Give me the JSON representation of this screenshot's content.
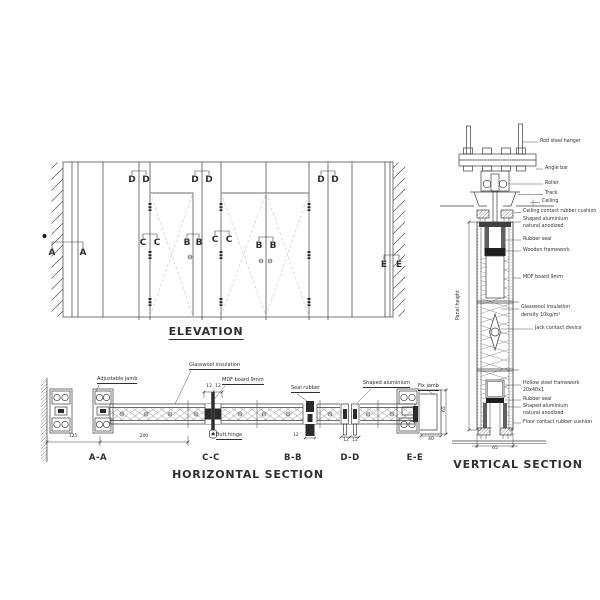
{
  "colors": {
    "line": "#3c3c3c",
    "text": "#2f2f2f",
    "background": "#ffffff"
  },
  "elevation": {
    "title": "ELEVATION",
    "marker_a": "A",
    "marker_b": "B",
    "marker_c": "C",
    "marker_d": "D",
    "marker_e": "E"
  },
  "horizontal_section": {
    "title": "HORIZONTAL SECTION",
    "labels": {
      "adjustable_jamb": "Adjustable jamb",
      "glasswool_insulation": "Glasswool insulation",
      "mdf_board": "MDF board 9mm",
      "seal_rubber": "Seal rubber",
      "butt_hinge": "Butt hinge",
      "shaped_aluminium": "Shaped aluminium",
      "fix_jamb": "Fix jamb"
    },
    "section_labels": {
      "aa": "A-A",
      "cc": "C-C",
      "bb": "B-B",
      "dd": "D-D",
      "ee": "E-E"
    },
    "dimensions": {
      "wall_offset": "125",
      "panel_span": "200",
      "cc_left": "12",
      "cc_right": "12",
      "bb_width": "12",
      "dd_left": "12",
      "dd_right": "12",
      "ee_bottom": "40",
      "ee_side": "65"
    }
  },
  "vertical_section": {
    "title": "VERTICAL SECTION",
    "labels": {
      "rod_steel_hanger": "Rod steel hanger",
      "angle_bar": "Angle bar",
      "roller": "Roller",
      "track": "Track",
      "ceiling": "Ceiling",
      "ceiling_cushion": "Ceiling contact rubber cushion",
      "shaped_aluminium_top_1": "Shaped aluminium",
      "shaped_aluminium_top_2": "natural anodized",
      "rubber_seal_top": "Rubber seal",
      "wooden_framework": "Wooden framework",
      "mdf_board": "MDF board 9mm",
      "glasswool_1": "Glasswool insulation",
      "glasswool_2": "density 10kg/m³",
      "jack_contact": "Jack contact device",
      "hollow_steel_1": "Hollow steel framework",
      "hollow_steel_2": "20x40x1",
      "rubber_seal_bottom": "Rubber seal",
      "shaped_aluminium_bottom_1": "Shaped aluminium",
      "shaped_aluminium_bottom_2": "natural anodized",
      "floor_cushion": "Floor contact rubber cushion",
      "panel_height": "Panel height"
    },
    "dimensions": {
      "bottom_width": "65"
    }
  }
}
